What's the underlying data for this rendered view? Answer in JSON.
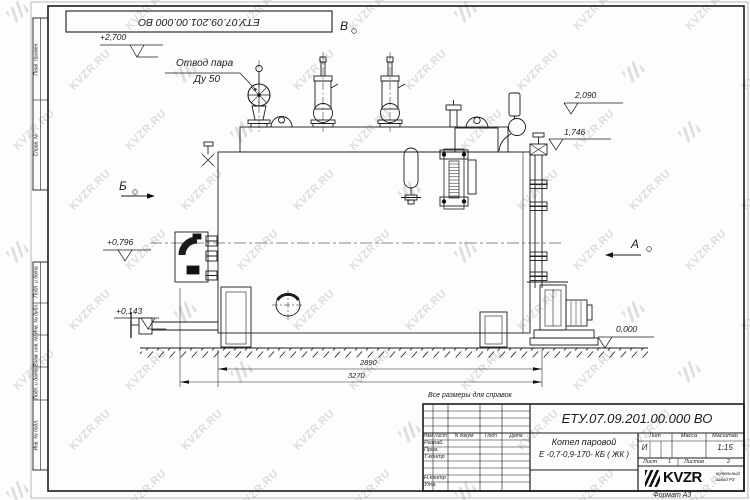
{
  "watermark": {
    "text": "KVZR.RU"
  },
  "sheet": {
    "stamp_top": "ЕТУ.07.09.201.00.000  ВО",
    "reference_note": "Все размеры для справок",
    "format_note": "Формат А3",
    "margin_labels": [
      "Перв. примен.",
      "Справ. №",
      "Подп. и дата",
      "Инв. № дубл.",
      "Взам. инв. №",
      "Подп. и дата",
      "Инв. № подл."
    ]
  },
  "drawing": {
    "callout": {
      "line1": "Отвод пара",
      "line2": "Ду 50"
    },
    "views": {
      "top": "В",
      "left": "Б",
      "right": "А"
    },
    "elevations": {
      "e2700": "+2,700",
      "e2090": "2,090",
      "e1746": "1,746",
      "e0796": "+0,796",
      "e0143": "+0,143",
      "e0000": "0,000"
    },
    "dimensions": {
      "length_shell": "2890",
      "length_overall": "3270"
    }
  },
  "title_block": {
    "doc_number": "ЕТУ.07.09.201.00.000  ВО",
    "product": {
      "line1": "Котел паровой",
      "line2": "Е -0,7-0,9-170- КБ ( ЖК )"
    },
    "columns": {
      "izm": "Изм",
      "list": "Лист",
      "doc": "N докум",
      "podp": "Подп",
      "date": "Дата"
    },
    "rows": {
      "razrab": "Разраб.",
      "prov": "Пров.",
      "tkontr": "Т.контр",
      "nkontr": "Н.контр",
      "utv": "Утв."
    },
    "lit": {
      "label": "Лит",
      "value": "И"
    },
    "mass": {
      "label": "Масса"
    },
    "scale": {
      "label": "Масштаб",
      "value": "1:15"
    },
    "sheet_no": {
      "label": "Лист",
      "value": "1"
    },
    "sheets": {
      "label": "Листов",
      "value": "2"
    },
    "logo": {
      "text": "KVZR",
      "sub1": "котельный",
      "sub2": "завод РЗ"
    }
  }
}
